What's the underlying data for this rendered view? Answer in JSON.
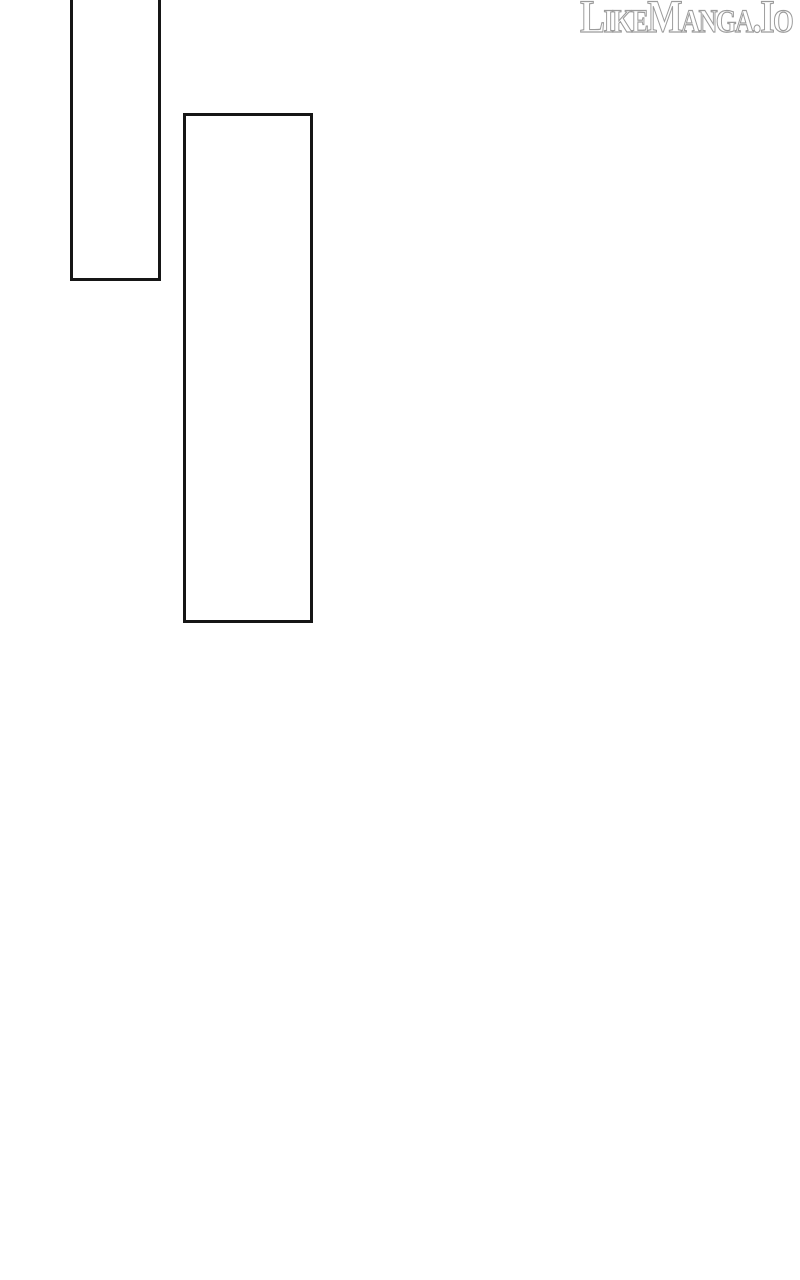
{
  "page": {
    "background_color": "#ffffff",
    "panel_border_color": "#161616"
  },
  "watermark": {
    "text": "LikeManga.Io",
    "outline_color": "#9b9b9b",
    "fill_color": "#ffffff"
  },
  "panels": [
    {
      "id": "panel-1",
      "content": ""
    },
    {
      "id": "panel-2",
      "content": ""
    }
  ]
}
